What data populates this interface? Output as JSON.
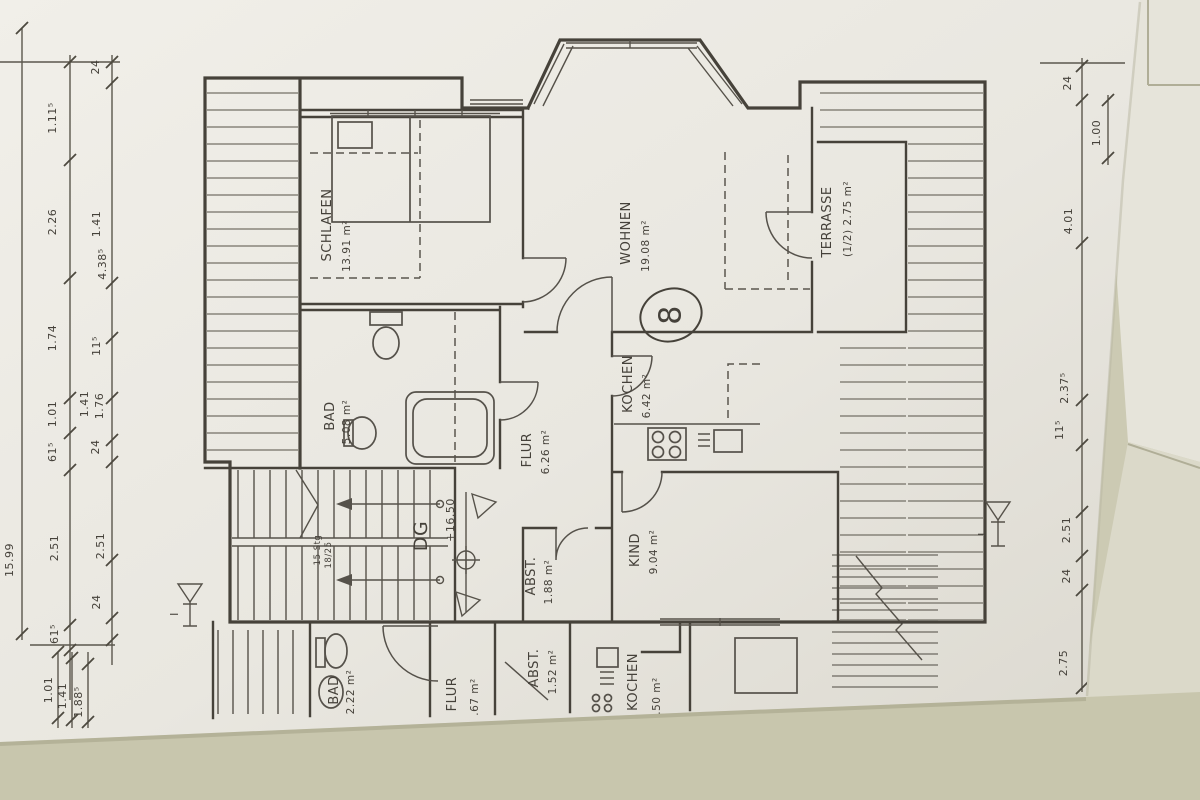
{
  "plan": {
    "floor_label": "DG",
    "apartment_number": "8",
    "elevation": "+16.50",
    "section_marker": "I",
    "stair_note": [
      "15 Stg",
      "18/25"
    ],
    "rooms_upper": [
      {
        "name": "SCHLAFEN",
        "area": "13.91 m²"
      },
      {
        "name": "BAD",
        "area": "5.08 m²"
      },
      {
        "name": "FLUR",
        "area": "6.26 m²"
      },
      {
        "name": "WOHNEN",
        "area": "19.08 m²"
      },
      {
        "name": "KOCHEN",
        "area": "6.42 m²"
      },
      {
        "name": "KIND",
        "area": "9.04 m²"
      },
      {
        "name": "ABST.",
        "area": "1.88 m²"
      },
      {
        "name": "TERRASSE",
        "area": "(1/2) 2.75 m²"
      }
    ],
    "rooms_lower": [
      {
        "name": "BAD",
        "area": "2.22 m²"
      },
      {
        "name": "FLUR",
        "area": ".67 m²"
      },
      {
        "name": "ABST.",
        "area": "1.52 m²"
      },
      {
        "name": "KOCHEN",
        "area": ".50 m²"
      }
    ],
    "dims": {
      "left_total": "15.99",
      "left_col1": [
        "1.11⁵",
        "2.26",
        "1.74",
        "1.01",
        "61⁵",
        "2.51",
        "61⁵"
      ],
      "left_col2": [
        "24",
        "1.41",
        "4.38⁵",
        "11⁵",
        "1.41",
        "1.76",
        "24",
        "2.51",
        "24"
      ],
      "left_bottom": [
        "1.01",
        "1.41",
        "1.88⁵"
      ],
      "right": [
        "24",
        "1.00",
        "4.01",
        "2.37⁵",
        "11⁵",
        "2.51",
        "24",
        "2.75"
      ]
    },
    "colors": {
      "paper": "#ebe9e2",
      "ink": "#46423a",
      "hatch": "#6e6a60",
      "table_light": "#e6e4da",
      "table_dark": "#c8c6ad"
    }
  }
}
